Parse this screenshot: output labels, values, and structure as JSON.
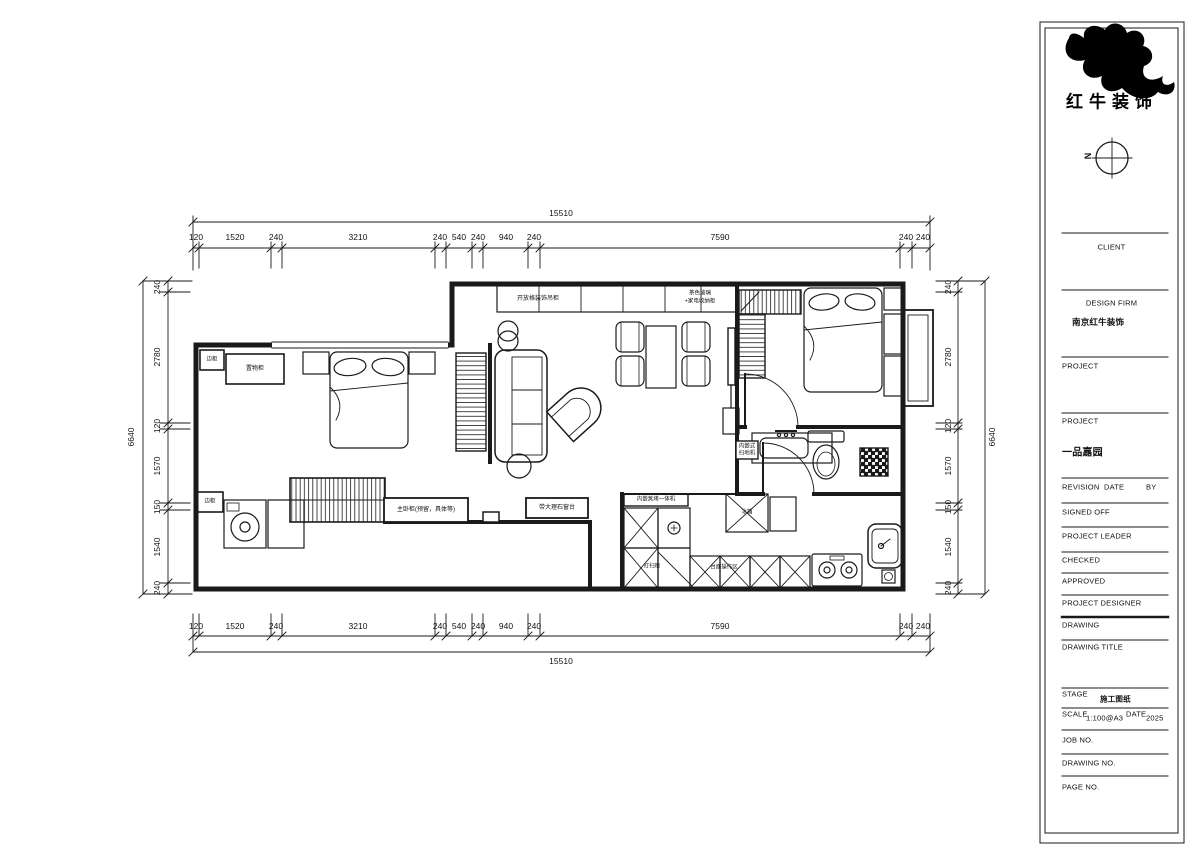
{
  "branding": {
    "company_cn": "红牛装饰",
    "compass_label": "N"
  },
  "title_block": {
    "client_label": "CLIENT",
    "design_firm_label": "DESIGN FIRM",
    "design_firm_value": "南京红牛装饰",
    "project1_label": "PROJECT",
    "project2_label": "PROJECT",
    "project_value": "一品嘉园",
    "revision_label": "REVISION",
    "date_label": "DATE",
    "by_label": "BY",
    "signed_off_label": "SIGNED OFF",
    "project_leader_label": "PROJECT LEADER",
    "checked_label": "CHECKED",
    "approved_label": "APPROVED",
    "project_designer_label": "PROJECT DESIGNER",
    "drawing_label": "DRAWING",
    "drawing_title_label": "DRAWING TITLE",
    "stage_label": "STAGE",
    "stage_value": "施工图纸",
    "scale_label": "SCALE",
    "scale_value": "1:100@A3",
    "date_field_label": "DATE",
    "date_value": "2025",
    "job_no_label": "JOB NO.",
    "drawing_no_label": "DRAWING NO.",
    "page_no_label": "PAGE NO."
  },
  "dimensions": {
    "top": {
      "total": "15510",
      "segments": [
        "120",
        "1520",
        "240",
        "3210",
        "240",
        "540",
        "240",
        "940",
        "240",
        "7590",
        "240",
        "240"
      ]
    },
    "bottom": {
      "total": "15510",
      "segments": [
        "120",
        "1520",
        "240",
        "3210",
        "240",
        "540",
        "240",
        "940",
        "240",
        "7590",
        "240",
        "240"
      ]
    },
    "left": {
      "total": "6640",
      "segments": [
        "240",
        "2780",
        "120",
        "1570",
        "150",
        "1540",
        "240"
      ]
    },
    "right": {
      "total": "6640",
      "segments": [
        "240",
        "2780",
        "120",
        "1570",
        "150",
        "1540",
        "240"
      ]
    }
  },
  "plan_labels": {
    "side_cabinet_top": "边柜",
    "storage_cabinet": "置物柜",
    "side_cabinet_bottom": "边柜",
    "wardrobe_note": "主卧柜(预留，具体等)",
    "window_sill_note": "带大理石窗台",
    "upper_cabinet_note": "开放格装饰吊柜",
    "upper_cabinet_note2_line1": "茶色玻璃",
    "upper_cabinet_note2_line2": "+家电收纳柜",
    "robot_vacuum_line1": "内嵌式",
    "robot_vacuum_line2": "扫地机",
    "tall_unit_note": "内嵌蒸烤一体机",
    "fridge_note": "冰箱",
    "base_cabinet_note1": "打扫柜",
    "base_cabinet_note2": "台面操作区"
  }
}
